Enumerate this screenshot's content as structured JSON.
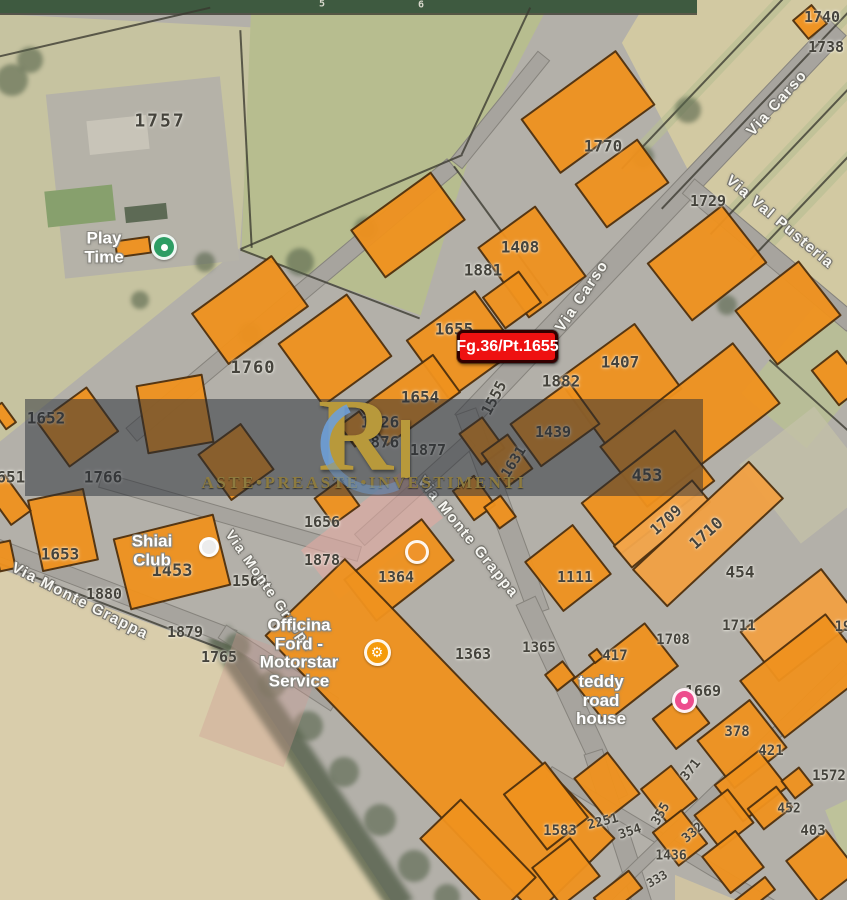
{
  "map": {
    "callout": {
      "text": "Fg.36/Pt.1655",
      "bg": "#ee1111"
    },
    "watermark": {
      "logo_letter": "R",
      "text": "ASTE•PREASTE•INVESTIMENTI",
      "gold": "#b8993b",
      "band_color": "rgba(38,44,54,0.5)"
    },
    "colors": {
      "building_fill": "#F0921E",
      "building_outline": "#50300c",
      "road": "#a7a49e",
      "field_green": "#b7bd8f",
      "field_beige": "#d9cdab"
    },
    "street_labels": [
      {
        "name": "via-carso-north",
        "text": "Via Carso",
        "x": 777,
        "y": 103,
        "r": -48,
        "s": 15
      },
      {
        "name": "via-carso-center",
        "text": "Via Carso",
        "x": 582,
        "y": 296,
        "r": -56,
        "s": 15
      },
      {
        "name": "via-val-pusteria",
        "text": "Via Val Pusteria",
        "x": 780,
        "y": 222,
        "r": 40,
        "s": 15
      },
      {
        "name": "via-monte-grappa-west",
        "text": "Via Monte Grappa",
        "x": 80,
        "y": 601,
        "r": 27,
        "s": 15
      },
      {
        "name": "via-monte-grappa-mid",
        "text": "Via Monte Grappa",
        "x": 270,
        "y": 590,
        "r": 55,
        "s": 14
      },
      {
        "name": "via-monte-grappa-center",
        "text": "Via Monte Grappa",
        "x": 468,
        "y": 537,
        "r": 51,
        "s": 15
      }
    ],
    "parcel_labels": [
      {
        "t": "1757",
        "x": 160,
        "y": 121,
        "s": 18,
        "sp": 2
      },
      {
        "t": "1770",
        "x": 603,
        "y": 146
      },
      {
        "t": "1740",
        "x": 822,
        "y": 17,
        "s": 15
      },
      {
        "t": "1738",
        "x": 826,
        "y": 47,
        "s": 15
      },
      {
        "t": "1729",
        "x": 708,
        "y": 201,
        "s": 15
      },
      {
        "t": "1408",
        "x": 520,
        "y": 247
      },
      {
        "t": "1881",
        "x": 483,
        "y": 270
      },
      {
        "t": "1655",
        "x": 454,
        "y": 329
      },
      {
        "t": "1407",
        "x": 620,
        "y": 362
      },
      {
        "t": "1882",
        "x": 561,
        "y": 381
      },
      {
        "t": "1555",
        "x": 494,
        "y": 398,
        "s": 15,
        "r": -62
      },
      {
        "t": "1760",
        "x": 253,
        "y": 368,
        "s": 17,
        "sp": 1
      },
      {
        "t": "1654",
        "x": 420,
        "y": 397
      },
      {
        "t": "1426",
        "x": 380,
        "y": 422
      },
      {
        "t": "1876",
        "x": 380,
        "y": 442
      },
      {
        "t": "1877",
        "x": 428,
        "y": 450,
        "s": 15
      },
      {
        "t": "1631",
        "x": 514,
        "y": 462,
        "s": 14,
        "r": -58
      },
      {
        "t": "1439",
        "x": 553,
        "y": 432,
        "s": 15
      },
      {
        "t": "453",
        "x": 647,
        "y": 476,
        "s": 17
      },
      {
        "t": "1709",
        "x": 666,
        "y": 520,
        "s": 15,
        "r": -42
      },
      {
        "t": "1710",
        "x": 706,
        "y": 533,
        "s": 16,
        "r": -42
      },
      {
        "t": "1111",
        "x": 575,
        "y": 577,
        "s": 15
      },
      {
        "t": "454",
        "x": 740,
        "y": 572
      },
      {
        "t": "1652",
        "x": 46,
        "y": 418
      },
      {
        "t": "1766",
        "x": 103,
        "y": 477
      },
      {
        "t": "1651",
        "x": 6,
        "y": 477
      },
      {
        "t": "1653",
        "x": 60,
        "y": 554
      },
      {
        "t": "1453",
        "x": 172,
        "y": 571,
        "s": 17
      },
      {
        "t": "1564",
        "x": 250,
        "y": 581,
        "s": 15
      },
      {
        "t": "1880",
        "x": 104,
        "y": 594,
        "s": 15
      },
      {
        "t": "1878",
        "x": 322,
        "y": 560,
        "s": 15
      },
      {
        "t": "1656",
        "x": 322,
        "y": 522,
        "s": 15
      },
      {
        "t": "1879",
        "x": 185,
        "y": 632,
        "s": 15
      },
      {
        "t": "1765",
        "x": 219,
        "y": 657,
        "s": 15
      },
      {
        "t": "1364",
        "x": 396,
        "y": 577,
        "s": 15
      },
      {
        "t": "1363",
        "x": 473,
        "y": 654,
        "s": 15
      },
      {
        "t": "1365",
        "x": 539,
        "y": 648,
        "s": 14
      },
      {
        "t": "417",
        "x": 615,
        "y": 656,
        "s": 14
      },
      {
        "t": "1708",
        "x": 673,
        "y": 640,
        "s": 14
      },
      {
        "t": "1711",
        "x": 739,
        "y": 626,
        "s": 14
      },
      {
        "t": "19",
        "x": 843,
        "y": 627,
        "s": 14
      },
      {
        "t": "1669",
        "x": 703,
        "y": 691,
        "s": 15
      },
      {
        "t": "378",
        "x": 737,
        "y": 732,
        "s": 14
      },
      {
        "t": "421",
        "x": 771,
        "y": 751,
        "s": 14
      },
      {
        "t": "371",
        "x": 691,
        "y": 770,
        "s": 13,
        "r": -52
      },
      {
        "t": "1572",
        "x": 829,
        "y": 776,
        "s": 14
      },
      {
        "t": "452",
        "x": 789,
        "y": 809,
        "s": 13
      },
      {
        "t": "403",
        "x": 813,
        "y": 831,
        "s": 14
      },
      {
        "t": "1583",
        "x": 560,
        "y": 831,
        "s": 14
      },
      {
        "t": "2251",
        "x": 603,
        "y": 822,
        "s": 13,
        "r": -14
      },
      {
        "t": "354",
        "x": 630,
        "y": 832,
        "s": 13,
        "r": -18
      },
      {
        "t": "355",
        "x": 661,
        "y": 814,
        "s": 13,
        "r": -60
      },
      {
        "t": "332",
        "x": 693,
        "y": 833,
        "s": 13,
        "r": -40
      },
      {
        "t": "1436",
        "x": 671,
        "y": 856,
        "s": 13
      },
      {
        "t": "333",
        "x": 657,
        "y": 879,
        "s": 12,
        "r": -30
      },
      {
        "t": "6",
        "x": 421,
        "y": 5,
        "s": 10,
        "c": "#d8d8cc"
      },
      {
        "t": "5",
        "x": 322,
        "y": 4,
        "s": 10,
        "c": "#d8d8cc"
      }
    ],
    "pois": [
      {
        "name": "poi-play-time",
        "text": "Play Time",
        "x": 104,
        "y": 248
      },
      {
        "name": "poi-shiai-club",
        "text": "Shiai Club",
        "x": 152,
        "y": 551
      },
      {
        "name": "poi-officina-ford",
        "text": "Officina Ford -\nMotorstar Service",
        "x": 299,
        "y": 654
      },
      {
        "name": "poi-teddy-road-house",
        "text": "teddy road house",
        "x": 601,
        "y": 701
      }
    ],
    "poi_icons": [
      {
        "name": "play-time-icon",
        "x": 164,
        "y": 247,
        "bg": "#2d9d64",
        "size": 26,
        "dot": true
      },
      {
        "name": "shiai-club-icon",
        "x": 209,
        "y": 547,
        "bg": "#ececec",
        "size": 20
      },
      {
        "name": "officina-wrench-icon",
        "x": 377,
        "y": 652,
        "bg": "#f59b0a",
        "size": 27,
        "glyph": "⚙"
      },
      {
        "name": "lodging-icon",
        "x": 684,
        "y": 700,
        "bg": "#ed4d8d",
        "size": 25,
        "dot": true
      },
      {
        "name": "faded-poi-icon",
        "x": 417,
        "y": 552,
        "bg": "rgba(242,150,50,0.55)",
        "size": 24
      }
    ],
    "buildings": [
      [
        588,
        112,
        118,
        68,
        -36
      ],
      [
        622,
        183,
        78,
        55,
        -36
      ],
      [
        408,
        225,
        100,
        60,
        -36
      ],
      [
        532,
        262,
        72,
        88,
        -36
      ],
      [
        512,
        300,
        46,
        40,
        -36
      ],
      [
        707,
        263,
        96,
        74,
        -38
      ],
      [
        788,
        313,
        82,
        70,
        -38
      ],
      [
        810,
        22,
        26,
        26,
        -40
      ],
      [
        838,
        378,
        34,
        46,
        -38
      ],
      [
        462,
        345,
        86,
        74,
        -36
      ],
      [
        620,
        384,
        96,
        82,
        -36
      ],
      [
        555,
        424,
        74,
        54,
        -36
      ],
      [
        410,
        400,
        92,
        48,
        -36
      ],
      [
        357,
        429,
        26,
        28,
        -36
      ],
      [
        482,
        441,
        30,
        40,
        -36
      ],
      [
        507,
        461,
        34,
        44,
        -36
      ],
      [
        474,
        498,
        28,
        38,
        -36
      ],
      [
        500,
        512,
        22,
        28,
        -36
      ],
      [
        250,
        310,
        100,
        64,
        -36
      ],
      [
        335,
        350,
        86,
        78,
        -36
      ],
      [
        175,
        414,
        68,
        70,
        -10
      ],
      [
        78,
        427,
        62,
        56,
        -36
      ],
      [
        236,
        462,
        54,
        58,
        -36
      ],
      [
        63,
        530,
        58,
        74,
        -12
      ],
      [
        8,
        500,
        26,
        46,
        -36
      ],
      [
        4,
        416,
        14,
        26,
        -36
      ],
      [
        172,
        562,
        104,
        74,
        -14
      ],
      [
        5,
        556,
        18,
        30,
        -12
      ],
      [
        133,
        247,
        36,
        18,
        -8
      ],
      [
        337,
        502,
        34,
        34,
        -36
      ],
      [
        399,
        570,
        100,
        54,
        -38
      ],
      [
        440,
        737,
        390,
        112,
        46
      ],
      [
        478,
        858,
        110,
        58,
        46
      ],
      [
        690,
        425,
        170,
        78,
        -38
      ],
      [
        648,
        492,
        120,
        66,
        -38
      ],
      [
        662,
        524,
        104,
        30,
        -40,
        "#F3A54A"
      ],
      [
        708,
        534,
        160,
        52,
        -43,
        "#F2A143"
      ],
      [
        568,
        568,
        62,
        64,
        -38
      ],
      [
        800,
        625,
        104,
        64,
        -38,
        "#F2A143"
      ],
      [
        625,
        673,
        94,
        56,
        -38
      ],
      [
        596,
        656,
        12,
        12,
        -38
      ],
      [
        560,
        676,
        24,
        22,
        -38
      ],
      [
        805,
        676,
        110,
        74,
        -38
      ],
      [
        742,
        744,
        68,
        62,
        -38
      ],
      [
        681,
        721,
        44,
        40,
        -38
      ],
      [
        751,
        786,
        58,
        48,
        -38
      ],
      [
        797,
        783,
        24,
        24,
        -38
      ],
      [
        546,
        806,
        54,
        72,
        -38
      ],
      [
        607,
        786,
        44,
        54,
        -38
      ],
      [
        669,
        794,
        40,
        44,
        -38
      ],
      [
        724,
        819,
        44,
        44,
        -38
      ],
      [
        770,
        808,
        38,
        28,
        -38
      ],
      [
        680,
        838,
        38,
        44,
        -38
      ],
      [
        733,
        862,
        44,
        48,
        -38
      ],
      [
        822,
        866,
        52,
        54,
        -38
      ],
      [
        566,
        872,
        50,
        50,
        -38
      ],
      [
        618,
        893,
        46,
        24,
        -38
      ],
      [
        755,
        895,
        40,
        18,
        -38
      ]
    ],
    "roads": [
      [
        650,
        225,
        545,
        24,
        -46.5
      ],
      [
        502,
        512,
        215,
        22,
        70
      ],
      [
        572,
        700,
        220,
        22,
        65
      ],
      [
        618,
        830,
        165,
        20,
        72
      ],
      [
        770,
        255,
        215,
        20,
        40
      ],
      [
        292,
        300,
        420,
        18,
        -40
      ],
      [
        115,
        592,
        255,
        17,
        21
      ],
      [
        278,
        668,
        135,
        16,
        33
      ],
      [
        230,
        517,
        270,
        16,
        16
      ],
      [
        415,
        490,
        150,
        16,
        -42
      ],
      [
        500,
        110,
        140,
        16,
        -51
      ],
      [
        660,
        838,
        260,
        13,
        31
      ],
      [
        725,
        782,
        340,
        13,
        -44
      ]
    ],
    "lines": [
      [
        496,
        81,
        162,
        -65
      ],
      [
        351,
        202,
        241,
        -23
      ],
      [
        246,
        139,
        218,
        87
      ],
      [
        105,
        32,
        216,
        -13
      ],
      [
        330,
        284,
        192,
        21
      ],
      [
        501,
        231,
        160,
        54
      ],
      [
        808,
        395,
        105,
        42
      ],
      [
        725,
        60,
        300,
        -46.5
      ],
      [
        765,
        100,
        300,
        -46.5
      ],
      [
        800,
        140,
        260,
        -46.5
      ],
      [
        826,
        180,
        220,
        -46.5
      ],
      [
        115,
        608,
        260,
        21
      ],
      [
        348,
        14,
        697,
        0
      ]
    ],
    "fields": [
      {
        "x": 0,
        "y": 14,
        "w": 480,
        "h": 450,
        "c": "#c6c3a0",
        "clip": "polygon(0% 0%,53% 3%,50% 52%,0% 95%)"
      },
      {
        "x": 235,
        "y": 5,
        "w": 320,
        "h": 320,
        "c": "#b7bd8f",
        "clip": "polygon(5% 2%,97% 2%,73% 48%,58% 97%,2% 77%)"
      },
      {
        "x": 615,
        "y": 0,
        "w": 232,
        "h": 330,
        "c": "#d2c9a2",
        "clip": "polygon(14% 0%,100% 0%,100% 96%,37% 59%,3% 13%)"
      },
      {
        "x": 575,
        "y": 54,
        "w": 300,
        "h": 13,
        "c": "#b9bf93",
        "r": -46.5,
        "op": 0.65
      },
      {
        "x": 615,
        "y": 94,
        "w": 300,
        "h": 13,
        "c": "#b9bf93",
        "r": -46.5,
        "op": 0.65
      },
      {
        "x": 670,
        "y": 134,
        "w": 260,
        "h": 13,
        "c": "#b9bf93",
        "r": -46.5,
        "op": 0.65
      },
      {
        "x": 718,
        "y": 174,
        "w": 220,
        "h": 13,
        "c": "#b9bf93",
        "r": -46.5,
        "op": 0.65
      },
      {
        "x": 770,
        "y": 315,
        "w": 85,
        "h": 120,
        "c": "#b8bd97",
        "r": 40
      },
      {
        "x": 760,
        "y": 425,
        "w": 95,
        "h": 100,
        "c": "#c3c0a8",
        "r": -38,
        "op": 0.8
      },
      {
        "x": 0,
        "y": 540,
        "w": 420,
        "h": 360,
        "c": "#d9cdab",
        "clip": "polygon(0% 8%,54% 31%,93% 100%,0% 100%)"
      },
      {
        "x": 145,
        "y": 757,
        "w": 330,
        "h": 26,
        "c": "#4e5a44",
        "r": 56,
        "op": 0.75,
        "blur": 3
      },
      {
        "x": 55,
        "y": 85,
        "w": 175,
        "h": 185,
        "c": "#b5b2a8",
        "r": -6
      },
      {
        "x": 88,
        "y": 118,
        "w": 60,
        "h": 34,
        "c": "#c8c4b8",
        "r": -6
      },
      {
        "x": 125,
        "y": 205,
        "w": 42,
        "h": 16,
        "c": "#5d6a55",
        "r": -6
      },
      {
        "x": 46,
        "y": 188,
        "w": 68,
        "h": 36,
        "c": "#87a06d",
        "r": -6
      },
      {
        "x": 675,
        "y": 862,
        "w": 175,
        "h": 38,
        "c": "#cfc3a2",
        "clip": "polygon(0% 34%,35% 100%,0% 100%)"
      },
      {
        "x": 805,
        "y": 795,
        "w": 42,
        "h": 80,
        "c": "#bec29a",
        "clip": "polygon(48% 19%,100% 6%,100% 88%)"
      }
    ],
    "soft_buildings": [
      {
        "x": 306,
        "y": 503,
        "w": 132,
        "h": 62,
        "c": "rgba(226,170,162,0.6)",
        "r": -38
      },
      {
        "x": 215,
        "y": 645,
        "w": 90,
        "h": 110,
        "c": "rgba(205,155,145,0.35)",
        "r": 20
      }
    ],
    "trees": [
      [
        300,
        262,
        14
      ],
      [
        366,
        229,
        12
      ],
      [
        250,
        334,
        12
      ],
      [
        688,
        110,
        13
      ],
      [
        643,
        157,
        11
      ],
      [
        727,
        305,
        10
      ],
      [
        237,
        646,
        13
      ],
      [
        272,
        684,
        14
      ],
      [
        308,
        726,
        15
      ],
      [
        344,
        772,
        15
      ],
      [
        380,
        820,
        16
      ],
      [
        414,
        866,
        16
      ],
      [
        447,
        897,
        13
      ],
      [
        12,
        80,
        16
      ],
      [
        30,
        60,
        13
      ],
      [
        205,
        262,
        10
      ],
      [
        140,
        300,
        9
      ]
    ]
  }
}
